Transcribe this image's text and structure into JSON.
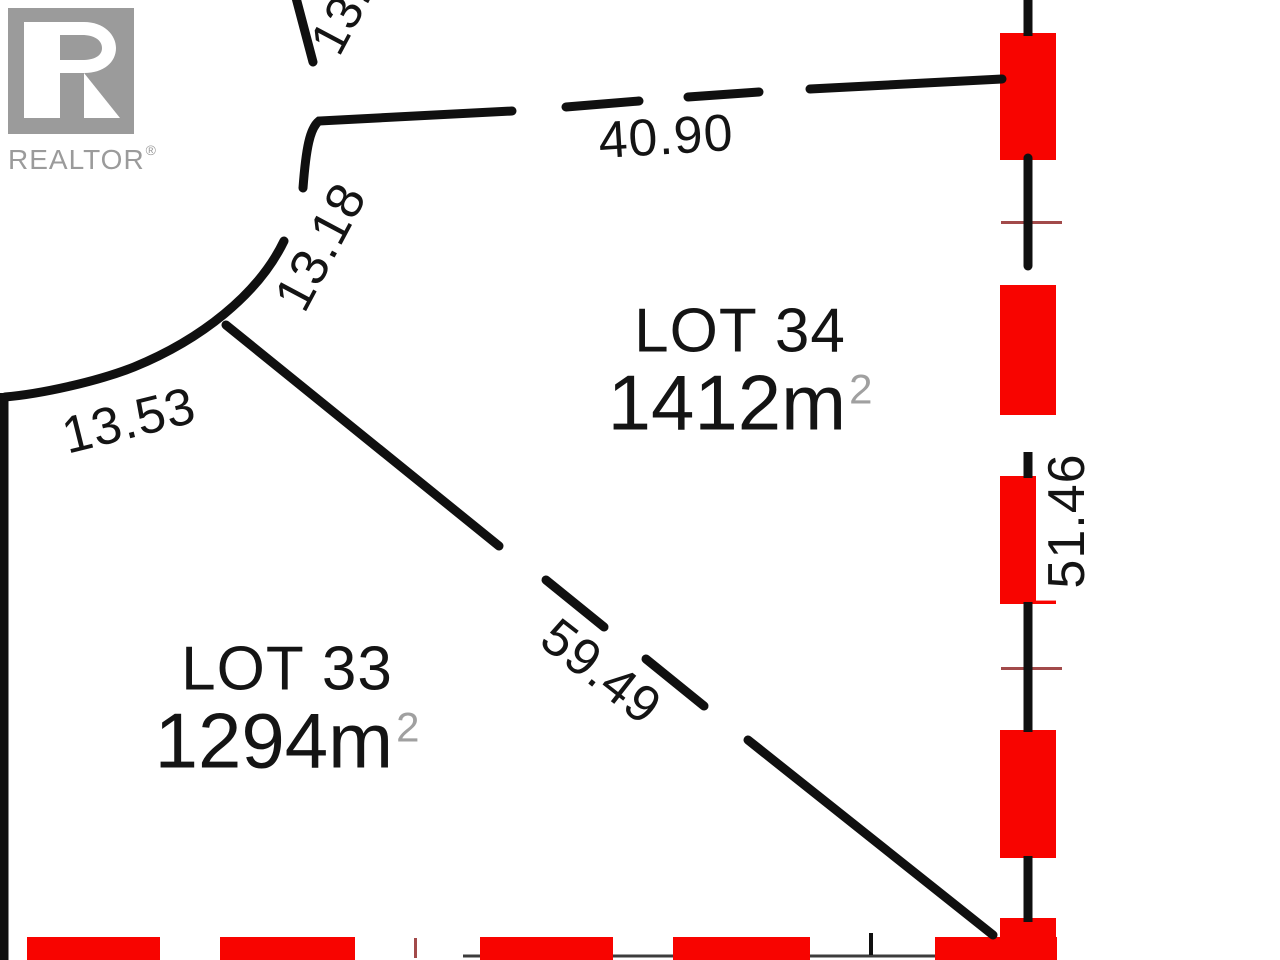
{
  "branding": {
    "logo_text": "REALTOR",
    "registered_mark": "®"
  },
  "lots": [
    {
      "id": "lot-34",
      "name": "LOT 34",
      "area": "1412m",
      "area_exponent": "2"
    },
    {
      "id": "lot-33",
      "name": "LOT 33",
      "area": "1294m",
      "area_exponent": "2"
    }
  ],
  "dimensions": {
    "street_top_partial": "13.",
    "north_boundary": "40.90",
    "curve_upper": "13.18",
    "curve_lower": "13.53",
    "diagonal_boundary": "59.49",
    "east_boundary": "51.46"
  },
  "colors": {
    "marker_red": "#f80400",
    "line_black": "#101010",
    "logo_gray": "#9b9b9b",
    "sup_gray": "#a0a0a0",
    "tick_maroon": "#a24a4a",
    "thin_line": "#3c3c3c"
  }
}
